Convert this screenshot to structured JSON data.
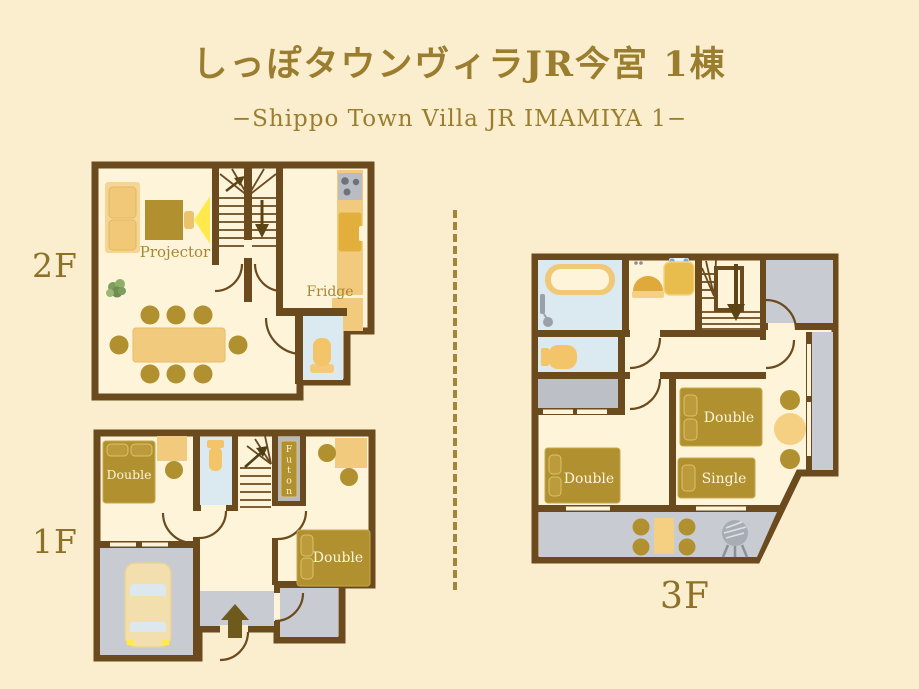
{
  "header": {
    "title": "しっぽタウンヴィラJR今宮 1棟",
    "subtitle": "−Shippo Town Villa JR IMAMIYA 1−"
  },
  "floor_2f": {
    "label": "2F",
    "projector": "Projector",
    "fridge": "Fridge"
  },
  "floor_1f": {
    "label": "1F",
    "bed_left": "Double",
    "bed_right": "Double",
    "futon": "Futon"
  },
  "floor_3f": {
    "label": "3F",
    "bed_left": "Double",
    "bed_right_double": "Double",
    "bed_right_single": "Single"
  },
  "colors": {
    "background": "#faeecf",
    "wall_brown": "#6b4a1e",
    "gold_text": "#96792c",
    "furniture_dark": "#b1902f",
    "furniture_light": "#f2ca7e",
    "floor_blue": "#dbe9f1",
    "floor_gray": "#c8ccd2",
    "beam_yellow": "#ffe94d"
  }
}
